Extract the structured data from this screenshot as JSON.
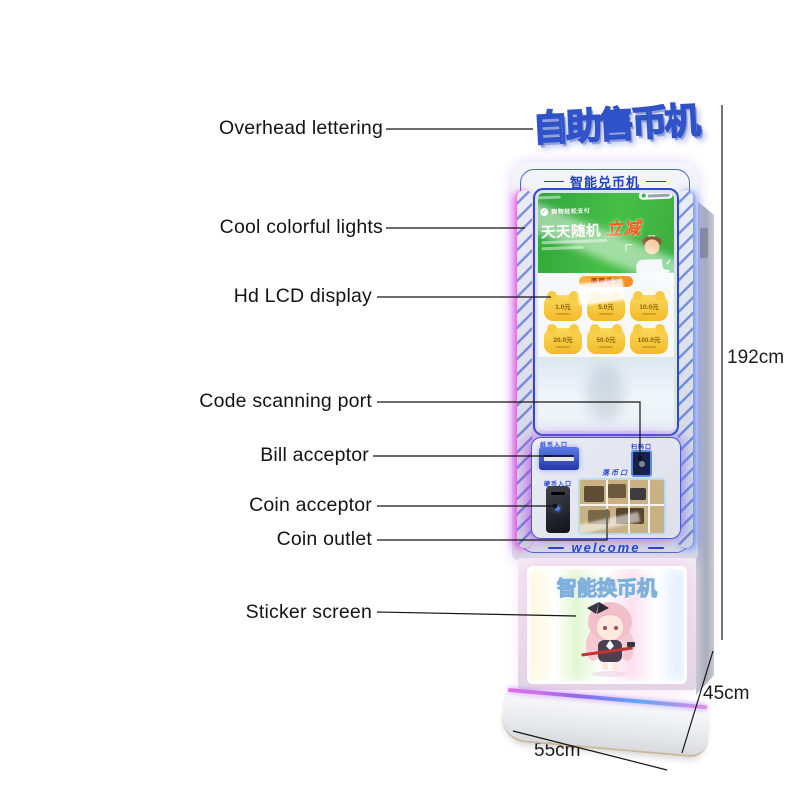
{
  "annotations": {
    "overhead": "Overhead lettering",
    "lights": "Cool colorful lights",
    "lcd": "Hd LCD display",
    "scan": "Code scanning port",
    "bill": "Bill acceptor",
    "coin": "Coin acceptor",
    "outlet": "Coin outlet",
    "sticker": "Sticker screen"
  },
  "dimensions": {
    "height": "192cm",
    "depth": "45cm",
    "width": "55cm"
  },
  "machine": {
    "top_sign": "自助售币机",
    "header": "智能兑币机",
    "screen": {
      "promo_small": "购物轻松支付",
      "promo_main": "天天随机",
      "promo_accent": "立减",
      "amount_header": "面额选择",
      "amounts": [
        "1.0元",
        "5.0元",
        "10.0元",
        "20.0元",
        "50.0元",
        "100.0元"
      ]
    },
    "ports": {
      "bill_label": "纸币入口",
      "scan_label": "扫码口",
      "coin_label": "硬币入口",
      "outlet_label": "落币口"
    },
    "welcome": "welcome",
    "sticker_sign": "智能换币机"
  },
  "icons": {
    "check": "✓"
  },
  "colors": {
    "accent_blue": "#2547cc",
    "banner_green": "#3db54a",
    "promo_orange": "#ff5a1e",
    "button_yellow": "#f5c53c",
    "glow_magenta": "#e060e0",
    "glow_blue": "#5f82fa"
  }
}
